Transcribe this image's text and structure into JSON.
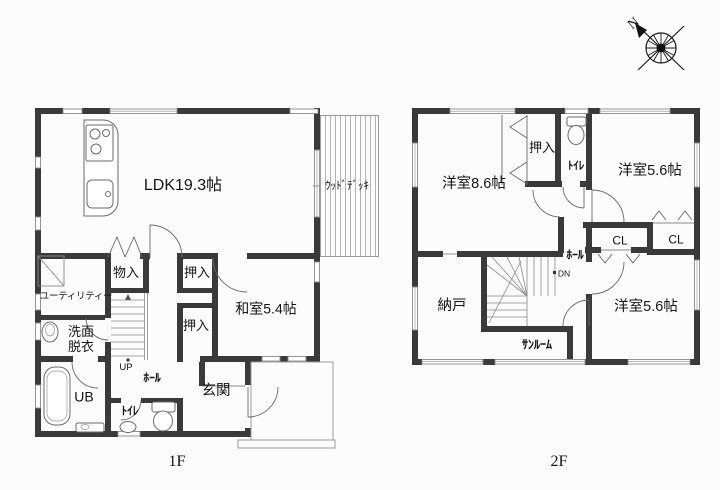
{
  "page": {
    "background": "#fcfcfc",
    "wall_color": "#3a3a3a",
    "line_color": "#777777",
    "text_color": "#141414"
  },
  "compass": {
    "north_label": "N"
  },
  "floor1": {
    "label": "1F",
    "rooms": {
      "ldk": "LDK19.3帖",
      "wood_deck": "ｳｯﾄﾞﾃﾞｯｷ",
      "storage": "物入",
      "closet_top": "押入",
      "utility": "ユーティリティー",
      "washroom": "洗面脱衣",
      "closet_bottom": "押入",
      "japanese_room": "和室5.4帖",
      "unit_bath": "UB",
      "toilet": "ﾄｲﾚ",
      "hall": "ﾎｰﾙ",
      "entrance": "玄関",
      "stairs": "UP"
    }
  },
  "floor2": {
    "label": "2F",
    "rooms": {
      "western_room_86": "洋室8.6帖",
      "closet": "押入",
      "toilet": "ﾄｲﾚ",
      "western_room_56_top": "洋室5.6帖",
      "cl_left": "CL",
      "cl_right": "CL",
      "hall": "ﾎｰﾙ",
      "stairs": "DN",
      "storage_room": "納戸",
      "sunroom": "ｻﾝﾙｰﾑ",
      "western_room_56_bottom": "洋室5.6帖"
    }
  }
}
